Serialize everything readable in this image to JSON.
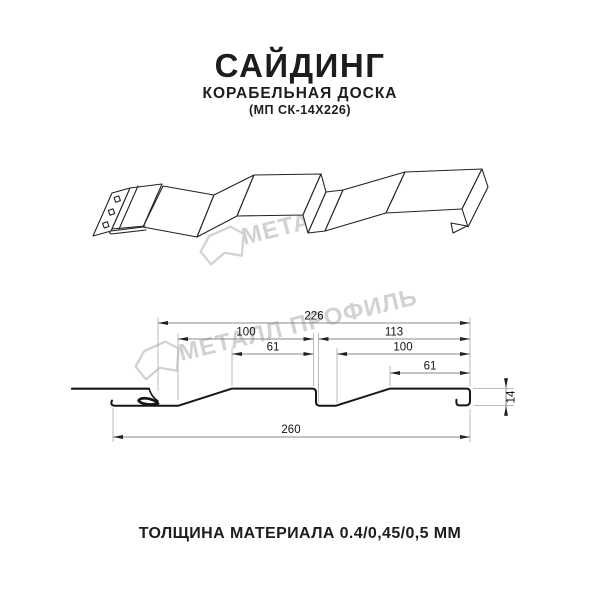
{
  "header": {
    "title": "САЙДИНГ",
    "subtitle": "КОРАБЕЛЬНАЯ ДОСКА",
    "model_code": "(МП СК-14Х226)"
  },
  "watermark": {
    "text": "МЕТАЛЛ ПРОФИЛЬ",
    "logo_name": "metal-profile-crystal-logo",
    "color": "#d2d2d2"
  },
  "section_drawing": {
    "units": "mm",
    "dimensions": {
      "overall_top": "226",
      "board_left": "100",
      "board_right": "113",
      "plateau_left": "61",
      "board_right_inner": "100",
      "plateau_right": "61",
      "overall_bottom": "260",
      "profile_height": "14"
    }
  },
  "footer": {
    "thickness_note": "ТОЛЩИНА МАТЕРИАЛА 0.4/0,45/0,5 ММ"
  },
  "colors": {
    "line": "#222222",
    "dimension_line": "#8a8a8a",
    "extension_line": "#b4b4b4",
    "watermark": "#d2d2d2",
    "background": "#ffffff"
  }
}
